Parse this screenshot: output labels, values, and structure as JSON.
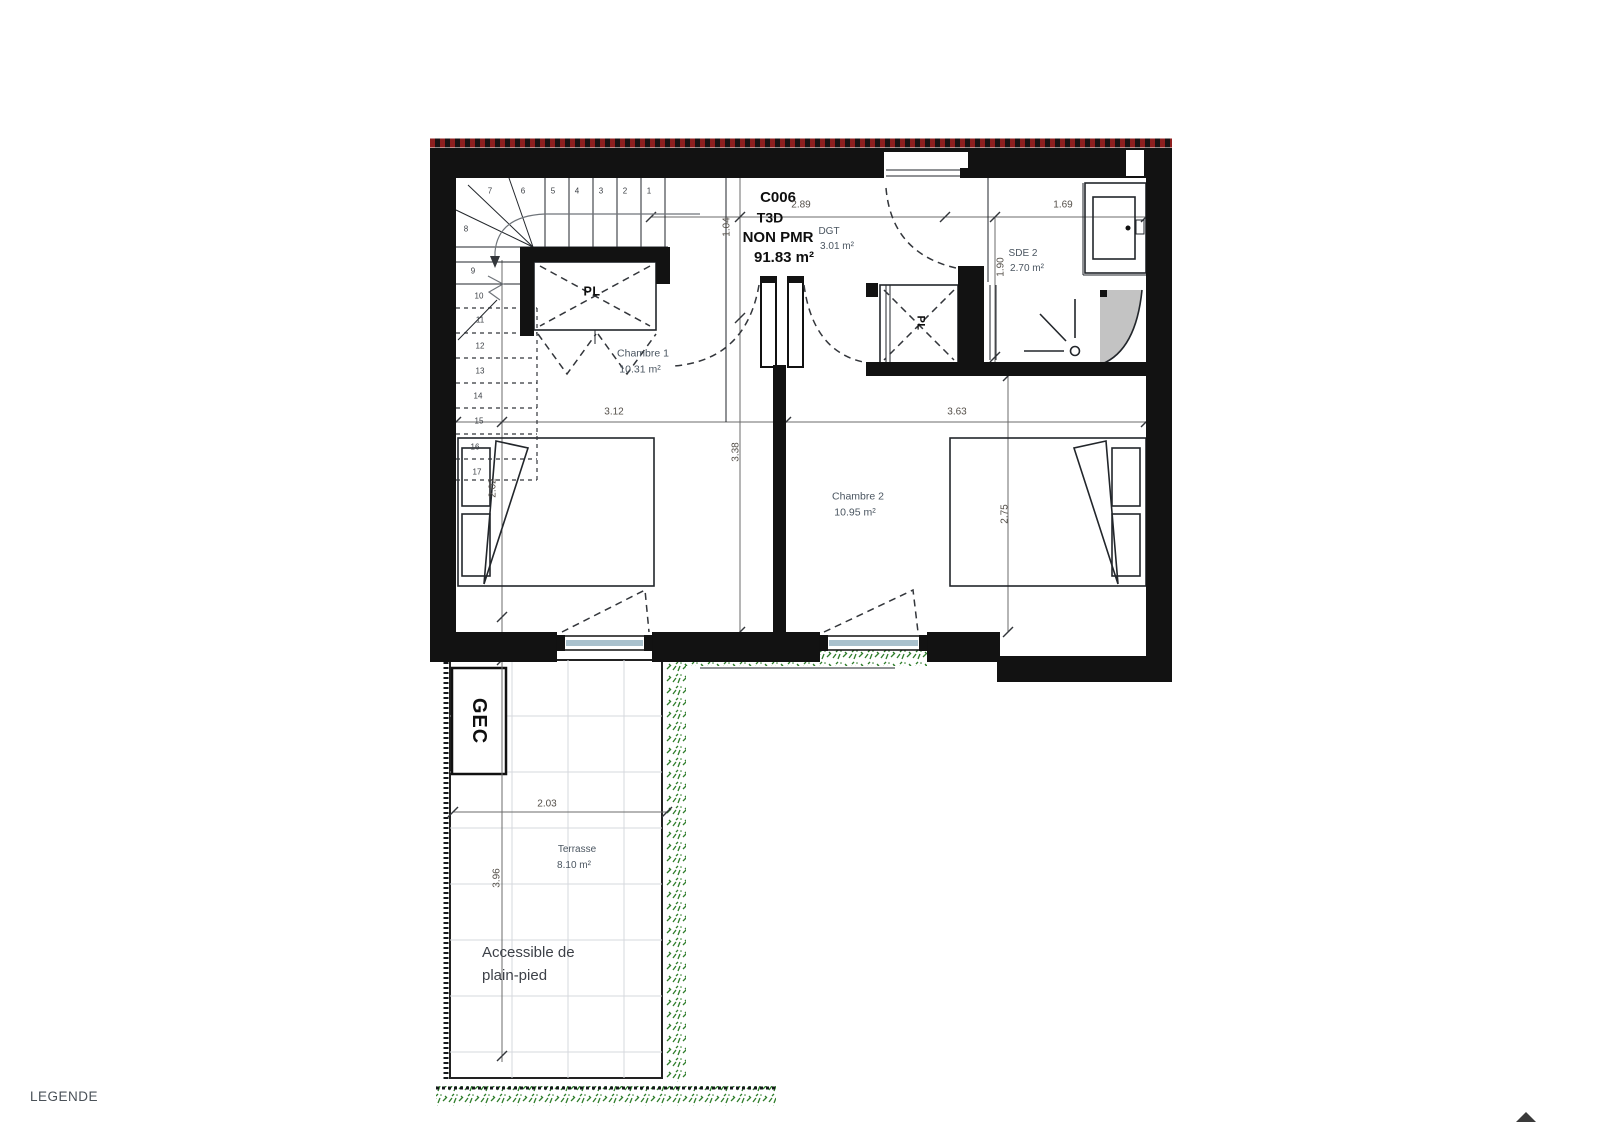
{
  "unit": {
    "code": "C006",
    "type": "T3D",
    "accessibility": "NON PMR",
    "area": "91.83 m²"
  },
  "rooms": {
    "dgt": {
      "name": "DGT",
      "area": "3.01 m²"
    },
    "sde2": {
      "name": "SDE 2",
      "area": "2.70 m²"
    },
    "chambre1": {
      "name": "Chambre 1",
      "area": "10.31 m²"
    },
    "chambre2": {
      "name": "Chambre 2",
      "area": "10.95 m²"
    },
    "terrasse": {
      "name": "Terrasse",
      "area": "8.10 m²"
    }
  },
  "annotations": {
    "closet1_label": "PL",
    "closet2_label": "PL",
    "duct_label": "GEC",
    "terrace_note_line1": "Accessible de",
    "terrace_note_line2": "plain-pied",
    "legend_title": "LEGENDE"
  },
  "stairs": {
    "steps": [
      {
        "n": "1",
        "x": 649,
        "y": 191
      },
      {
        "n": "2",
        "x": 625,
        "y": 191
      },
      {
        "n": "3",
        "x": 601,
        "y": 191
      },
      {
        "n": "4",
        "x": 577,
        "y": 191
      },
      {
        "n": "5",
        "x": 553,
        "y": 191
      },
      {
        "n": "6",
        "x": 523,
        "y": 191
      },
      {
        "n": "7",
        "x": 490,
        "y": 191
      },
      {
        "n": "8",
        "x": 466,
        "y": 229
      },
      {
        "n": "9",
        "x": 473,
        "y": 271
      },
      {
        "n": "10",
        "x": 479,
        "y": 296
      },
      {
        "n": "11",
        "x": 480,
        "y": 320
      },
      {
        "n": "12",
        "x": 480,
        "y": 346
      },
      {
        "n": "13",
        "x": 480,
        "y": 371
      },
      {
        "n": "14",
        "x": 478,
        "y": 396
      },
      {
        "n": "15",
        "x": 479,
        "y": 421
      },
      {
        "n": "16",
        "x": 475,
        "y": 447
      },
      {
        "n": "17",
        "x": 477,
        "y": 472
      }
    ]
  },
  "dimensions": [
    {
      "value": "2.89",
      "x": 801,
      "y": 205,
      "rotated": false
    },
    {
      "value": "1.69",
      "x": 1063,
      "y": 205,
      "rotated": false
    },
    {
      "value": "1.04",
      "x": 727,
      "y": 227,
      "rotated": true
    },
    {
      "value": "1.90",
      "x": 1001,
      "y": 267,
      "rotated": true
    },
    {
      "value": "3.12",
      "x": 614,
      "y": 412,
      "rotated": false
    },
    {
      "value": "3.63",
      "x": 957,
      "y": 412,
      "rotated": false
    },
    {
      "value": "3.38",
      "x": 736,
      "y": 452,
      "rotated": true
    },
    {
      "value": "2.02",
      "x": 493,
      "y": 488,
      "rotated": true
    },
    {
      "value": "2.75",
      "x": 1005,
      "y": 514,
      "rotated": true
    },
    {
      "value": "2.03",
      "x": 547,
      "y": 804,
      "rotated": false
    },
    {
      "value": "3.96",
      "x": 497,
      "y": 878,
      "rotated": true
    }
  ],
  "colors": {
    "wall": "#121212",
    "roof": "#8e1f1f",
    "glazing": "#a9c1cd",
    "veg": "#2f7d2b",
    "grid": "#d5d9dd",
    "dimc": "#55504a",
    "labelc": "#4a5560"
  }
}
